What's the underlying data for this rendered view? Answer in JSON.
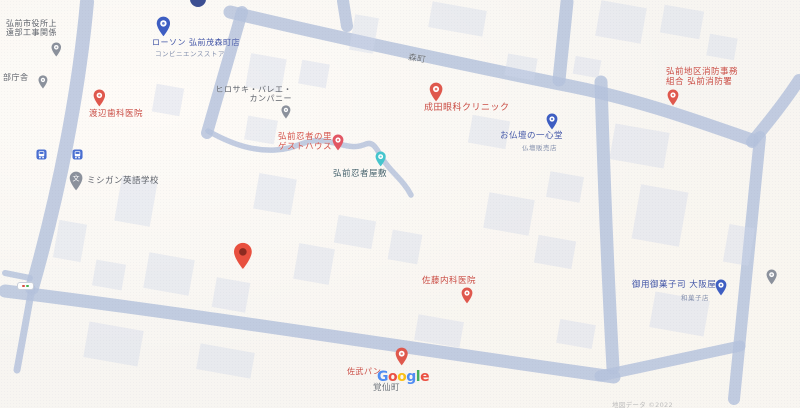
{
  "map": {
    "colors": {
      "background": "#f7f5f1",
      "road": "#b5c2dc",
      "building": "rgba(208,216,233,0.38)",
      "gray_pin": "#8b919c",
      "red_pin": "#df584d",
      "blue_pin": "#3e5ec2",
      "teal_pin": "#45c5cd",
      "lodging_pin": "#e25663",
      "main_marker": "#e8503f"
    },
    "attribution": "地図データ ©2022",
    "watermark": {
      "letters": [
        {
          "ch": "G",
          "color": "#4285F4"
        },
        {
          "ch": "o",
          "color": "#EA4335"
        },
        {
          "ch": "o",
          "color": "#FBBC05"
        },
        {
          "ch": "g",
          "color": "#4285F4"
        },
        {
          "ch": "l",
          "color": "#34A853"
        },
        {
          "ch": "e",
          "color": "#EA4335"
        }
      ]
    },
    "roads": [
      {
        "d": "M87,2 C79,90 60,190 32,288",
        "w": 14
      },
      {
        "d": "M32,288 L17,370",
        "w": 7
      },
      {
        "d": "M30,278 L5,273",
        "w": 6
      },
      {
        "d": "M242,12 L207,133",
        "w": 12
      },
      {
        "d": "M230,12 C330,36 480,68 570,86 C640,100 700,122 752,140",
        "w": 13
      },
      {
        "d": "M752,142 C772,118 786,100 799,80",
        "w": 12
      },
      {
        "d": "M343,1 L347,26",
        "w": 12
      },
      {
        "d": "M567,2 L559,80",
        "w": 13
      },
      {
        "d": "M601,82 C604,180 608,280 613,368",
        "w": 13
      },
      {
        "d": "M760,137 L734,399",
        "w": 12
      },
      {
        "d": "M5,291 C200,315 420,350 614,377",
        "w": 13
      },
      {
        "d": "M600,376 L740,346",
        "w": 11
      },
      {
        "d": "M208,131 C235,146 255,151 275,150 C298,149 305,138 325,141 C343,144 352,150 366,144 C374,141 377,150 384,161 C392,173 404,181 411,195",
        "w": 5.5
      }
    ],
    "bus_stops": [
      {
        "x": 36,
        "y": 145
      },
      {
        "x": 72,
        "y": 145
      }
    ],
    "pois": [
      {
        "name": "construction-office",
        "lines": [
          "弘前市役所上",
          "遠部工事関係"
        ],
        "color": "#5d6169",
        "x": 6,
        "y": 20,
        "size": 8,
        "pin": {
          "color": "#8b919c",
          "x": 56,
          "y": 57,
          "h": 15,
          "inner": "dot"
        }
      },
      {
        "name": "chosha",
        "lines": [
          "部庁舎"
        ],
        "color": "#5d6169",
        "x": 3,
        "y": 74,
        "size": 8,
        "pin": {
          "color": "#8b919c",
          "x": 43,
          "y": 88,
          "h": 14,
          "inner": "dot"
        }
      },
      {
        "name": "lawson-hirosaki-shigemori",
        "lines": [
          "ローソン 弘前茂森町店"
        ],
        "color": "#4053a4",
        "x": 152,
        "y": 39,
        "size": 8,
        "sub": {
          "text": "コンビニエンスストア",
          "color": "#8490ad",
          "size": 6.5,
          "x": 155,
          "y": 48
        },
        "pin": {
          "color": "#3e5ec2",
          "x": 163,
          "y": 37,
          "h": 21,
          "inner": "dot"
        }
      },
      {
        "name": "watanabe-dental-clinic",
        "lines": [
          "渡辺歯科医院"
        ],
        "color": "#c94b42",
        "x": 89,
        "y": 110,
        "size": 8.5,
        "pin": {
          "color": "#df584d",
          "x": 99,
          "y": 107,
          "h": 18,
          "inner": "dot"
        }
      },
      {
        "name": "michigan-english-school",
        "lines": [
          "ミシガン英語学校"
        ],
        "color": "#5d6169",
        "x": 87,
        "y": 177,
        "size": 8.5,
        "pin": {
          "color": "#8b919c",
          "x": 76,
          "y": 191,
          "h": 20,
          "inner": "glyph",
          "glyph": "文"
        }
      },
      {
        "name": "hirosaki-ballet-company",
        "lines": [
          "ヒロサキ・バレエ・",
          "カンパニー"
        ],
        "color": "#5d6169",
        "x": 215,
        "y": 86,
        "size": 8,
        "align": "right",
        "width": 77,
        "pin": {
          "color": "#8b919c",
          "x": 286,
          "y": 118,
          "h": 14,
          "inner": "dot"
        }
      },
      {
        "name": "ninja-guesthouse",
        "lines": [
          "弘前忍者の里",
          "ゲストハウス"
        ],
        "color": "#d4544b",
        "x": 278,
        "y": 133,
        "size": 8.5,
        "pin": {
          "color": "#e25663",
          "x": 338,
          "y": 151,
          "h": 17,
          "inner": "dot"
        }
      },
      {
        "name": "hirosaki-ninja-house",
        "lines": [
          "弘前忍者屋敷"
        ],
        "color": "#47636c",
        "x": 333,
        "y": 170,
        "size": 8.5,
        "pin": {
          "color": "#45c5cd",
          "x": 381,
          "y": 167,
          "h": 16,
          "inner": "dot"
        }
      },
      {
        "name": "morimachi-road-label",
        "lines": [
          "森町"
        ],
        "color": "#6b7077",
        "x": 408,
        "y": 55,
        "size": 8.5,
        "rotate": 9
      },
      {
        "name": "narita-eye-clinic",
        "lines": [
          "成田眼科クリニック"
        ],
        "color": "#c94b42",
        "x": 424,
        "y": 103,
        "size": 9,
        "pin": {
          "color": "#df584d",
          "x": 436,
          "y": 102,
          "h": 20,
          "inner": "dot"
        }
      },
      {
        "name": "isshindo-butsudan",
        "lines": [
          "お仏壇の一心堂"
        ],
        "color": "#4053a4",
        "x": 500,
        "y": 132,
        "size": 8.5,
        "sub": {
          "text": "仏壇販売店",
          "color": "#8490ad",
          "size": 6.5,
          "x": 522,
          "y": 142
        },
        "pin": {
          "color": "#3e5ec2",
          "x": 552,
          "y": 130,
          "h": 17,
          "inner": "dot"
        }
      },
      {
        "name": "hirosaki-fire-station",
        "lines": [
          "弘前地区消防事務",
          "組合 弘前消防署"
        ],
        "color": "#c94b42",
        "x": 666,
        "y": 68,
        "size": 8.5,
        "pin": {
          "color": "#df584d",
          "x": 673,
          "y": 106,
          "h": 17,
          "inner": "dot"
        }
      },
      {
        "name": "osakaya-wagashi",
        "lines": [
          "御用御菓子司 大阪屋"
        ],
        "color": "#4053a4",
        "x": 632,
        "y": 281,
        "size": 8.5,
        "sub": {
          "text": "和菓子店",
          "color": "#8490ad",
          "size": 6.5,
          "x": 681,
          "y": 292
        },
        "pin": {
          "color": "#3e5ec2",
          "x": 721,
          "y": 296,
          "h": 17,
          "inner": "dot"
        }
      },
      {
        "name": "unlabeled-poi",
        "lines": [],
        "pin": {
          "color": "#8b919c",
          "x": 772,
          "y": 285,
          "h": 16,
          "inner": "dot"
        }
      },
      {
        "name": "sato-internal-medicine",
        "lines": [
          "佐藤内科医院"
        ],
        "color": "#c94b42",
        "x": 422,
        "y": 277,
        "size": 8.5,
        "pin": {
          "color": "#df584d",
          "x": 467,
          "y": 304,
          "h": 17,
          "inner": "dot"
        }
      },
      {
        "name": "main-location-marker",
        "lines": [],
        "pin": {
          "color": "#e8503f",
          "x": 243,
          "y": 270,
          "h": 28,
          "inner": "dark"
        }
      },
      {
        "name": "sabu-bakery",
        "lines": [
          "佐武パン"
        ],
        "color": "#c94b42",
        "x": 347,
        "y": 368,
        "size": 8,
        "pin": {
          "color": "#df584d",
          "x": 402,
          "y": 366,
          "h": 19,
          "inner": "dot"
        }
      },
      {
        "name": "kakusencho-town-label",
        "lines": [
          "覚仙町"
        ],
        "color": "#6b7077",
        "x": 373,
        "y": 384,
        "size": 8.5
      }
    ]
  }
}
